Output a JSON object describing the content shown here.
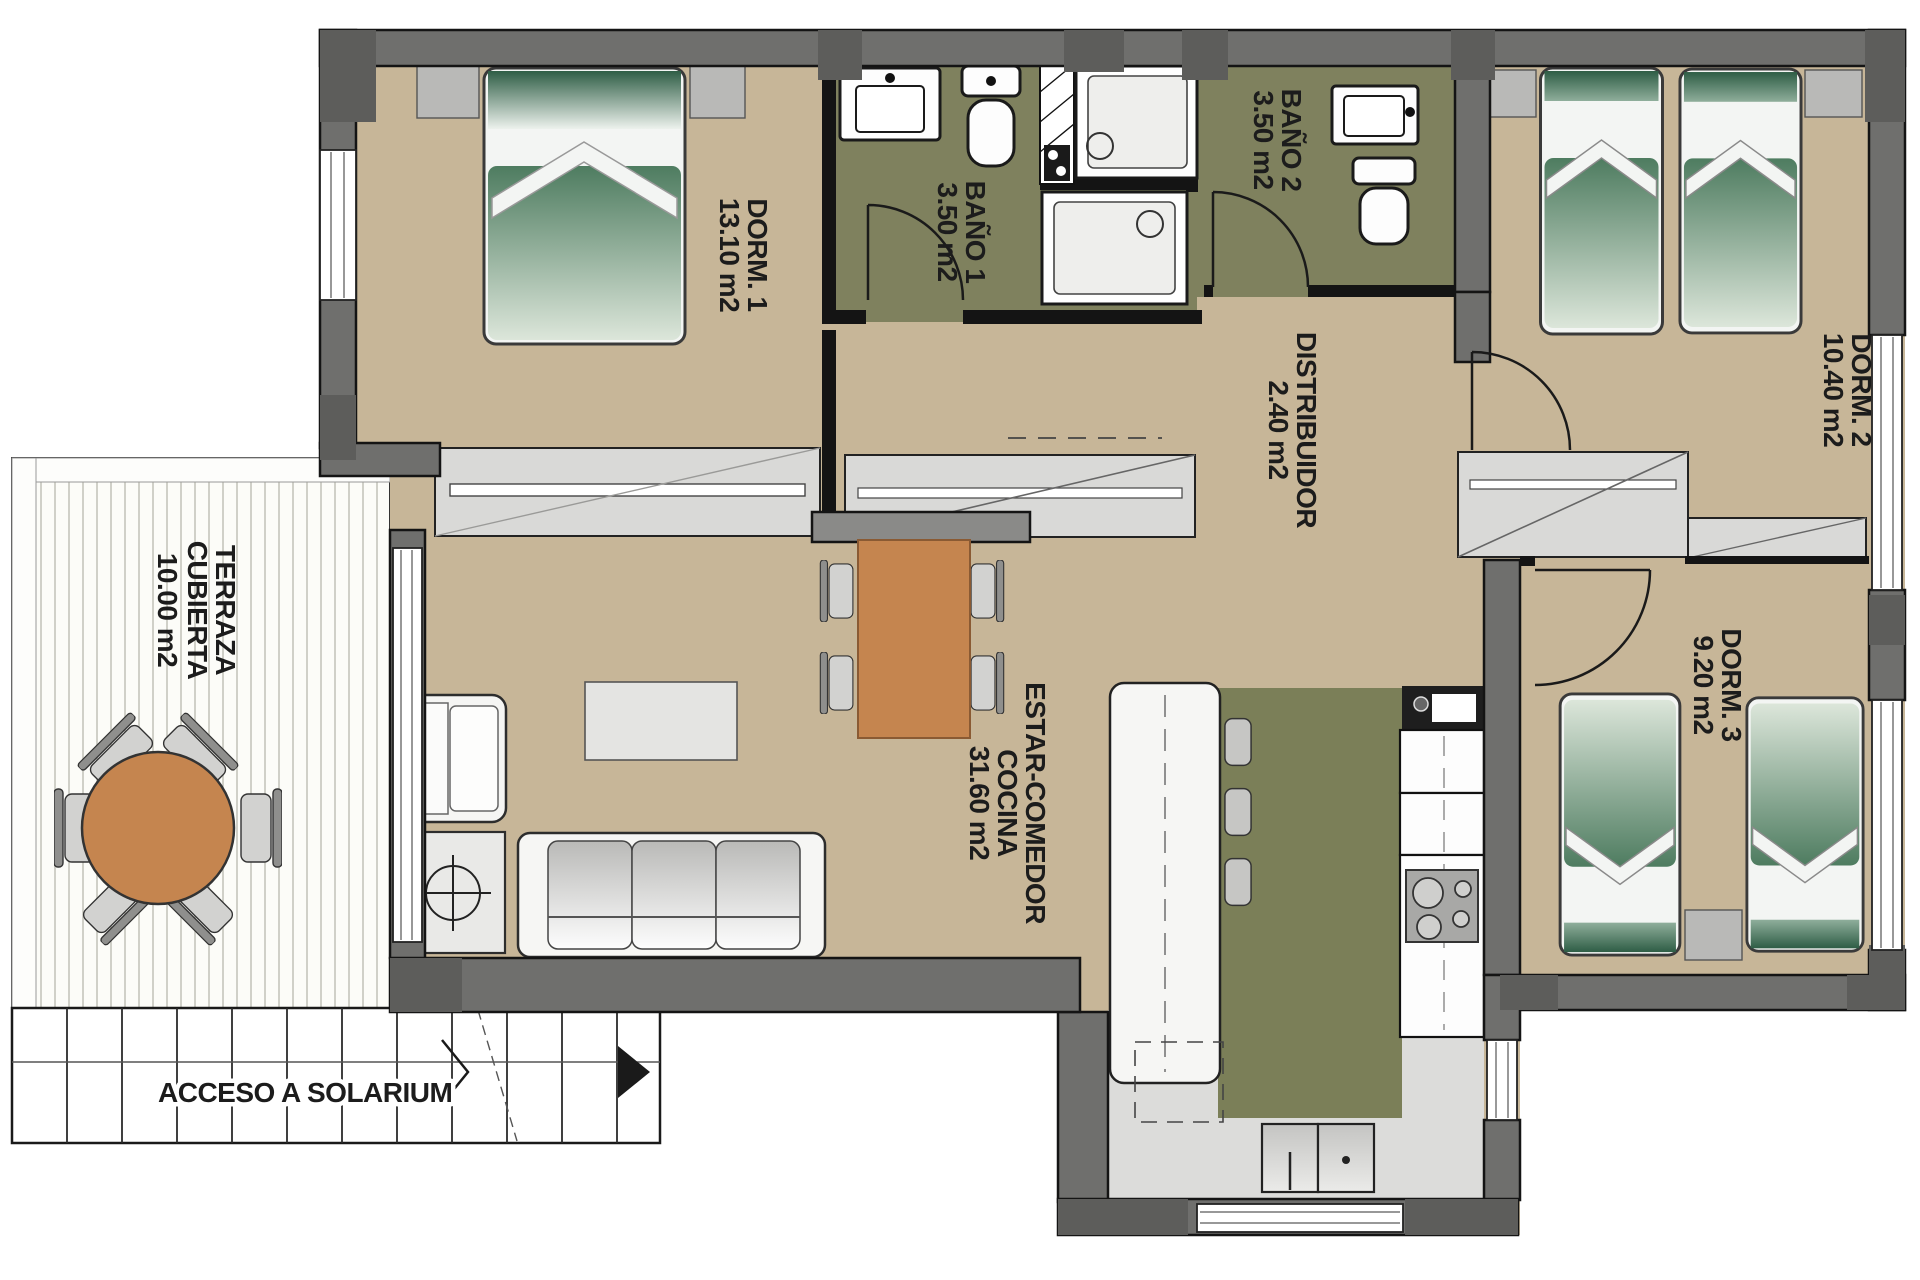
{
  "plan": {
    "title": "apartment-floor-plan",
    "rooms": {
      "dorm1": {
        "name": "DORM. 1",
        "area": "13.10 m2"
      },
      "bano1": {
        "name": "BAÑO 1",
        "area": "3.50 m2"
      },
      "bano2": {
        "name": "BAÑO 2",
        "area": "3.50 m2"
      },
      "dorm2": {
        "name": "DORM. 2",
        "area": "10.40 m2"
      },
      "distribuidor": {
        "name": "DISTRIBUIDOR",
        "area": "2.40 m2"
      },
      "dorm3": {
        "name": "DORM. 3",
        "area": "9.20 m2"
      },
      "estar": {
        "name_line1": "ESTAR-COMEDOR",
        "name_line2": "COCINA",
        "area": "31.60 m2"
      },
      "terraza": {
        "name_line1": "TERRAZA",
        "name_line2": "CUBIERTA",
        "area": "10.00 m2"
      }
    },
    "annotations": {
      "stairs": "ACCESO A SOLARIUM"
    },
    "symbols": [
      "double-bed-icon",
      "single-bed-icon",
      "shower-icon",
      "washbasin-icon",
      "toilet-icon",
      "sofa-icon",
      "armchair-icon",
      "dining-table-icon",
      "round-table-icon",
      "hob-icon",
      "kitchen-sink-icon",
      "wardrobe-icon",
      "stairs-arrow-icon",
      "floor-lamp-icon"
    ],
    "colors": {
      "wall": "#6f6f6d",
      "wall_dark": "#5d5d5b",
      "sill_gray": "#b9b9b7",
      "floor_tan": "#c7b698",
      "bathroom_olive": "#7f815e",
      "kitchen_olive": "#7b7f58",
      "bed_green": "#3a6b50",
      "table_orange": "#c5854f",
      "closet_gray": "#d9d9d7",
      "floor_gray": "#dcdcda",
      "outline": "#141414"
    }
  }
}
